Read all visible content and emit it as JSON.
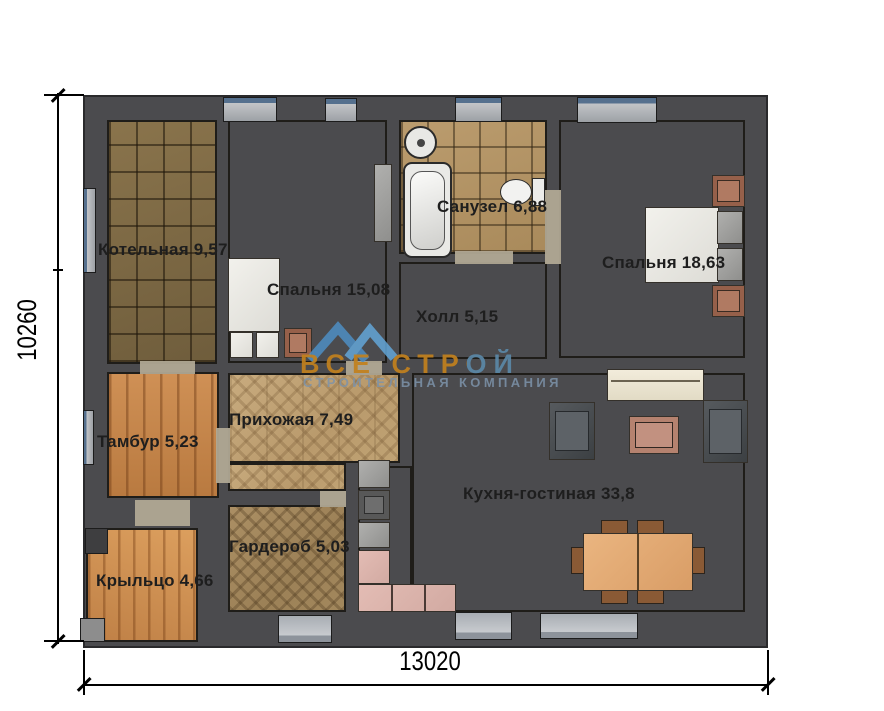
{
  "watermark": {
    "title": "ВСЕ СТРОЙ",
    "subtitle": "СТРОИТЕЛЬНАЯ КОМПАНИЯ"
  },
  "dimensions": {
    "width": "13020",
    "height": "10260"
  },
  "rooms": {
    "boiler": {
      "label": "Котельная 9,57"
    },
    "bedroom1": {
      "label": "Спальня 15,08"
    },
    "bathroom": {
      "label": "Санузел 6,88"
    },
    "bedroom2": {
      "label": "Спальня 18,63"
    },
    "hall": {
      "label": "Холл 5,15"
    },
    "vestibule": {
      "label": "Тамбур 5,23"
    },
    "entry": {
      "label": "Прихожая 7,49"
    },
    "kitchen_living": {
      "label": "Кухня-гостиная 33,8"
    },
    "wardrobe": {
      "label": "Гардероб 5,03"
    },
    "porch": {
      "label": "Крыльцо 4,66"
    }
  },
  "colors": {
    "wall": "#4b4b4e",
    "accent_orange": "#c2811e",
    "accent_blue": "#5b9ad0"
  }
}
